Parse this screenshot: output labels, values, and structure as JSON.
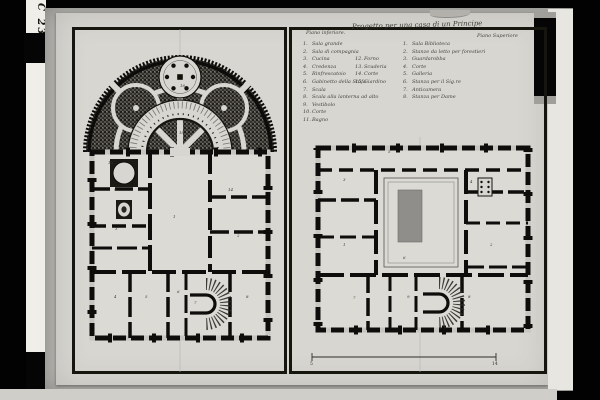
{
  "photo": {
    "shelf_mark": "C 23",
    "colors": {
      "background": "#020202",
      "paper": "#d7d6d1",
      "mount": "#b7b6b1",
      "ink": "#16160f",
      "courtyard_shading": "#8f8e8a"
    }
  },
  "legend": {
    "title": "Progetto per una casa di un Principe",
    "left_heading": "Piano inferiore.",
    "right_heading": "Piano Superiore",
    "left_items": [
      {
        "no": "1.",
        "text": "Sala grande"
      },
      {
        "no": "2.",
        "text": "Sala di compagnia"
      },
      {
        "no": "3.",
        "text": "Cucina",
        "no2": "12.",
        "text2": "Forno"
      },
      {
        "no": "4.",
        "text": "Credenza",
        "no2": "13.",
        "text2": "Scuderia"
      },
      {
        "no": "5.",
        "text": "Rinfrescatoio",
        "no2": "14.",
        "text2": "Corte"
      },
      {
        "no": "6.",
        "text": "Gabinetto della Stufa",
        "no2": "15.",
        "text2": "Giardino"
      },
      {
        "no": "7.",
        "text": "Scala"
      },
      {
        "no": "8.",
        "text": "Scala alla lanterna ad alto"
      },
      {
        "no": "9.",
        "text": "Vestibolo"
      },
      {
        "no": "10.",
        "text": "Corte"
      },
      {
        "no": "11.",
        "text": "Bagno"
      }
    ],
    "right_items": [
      {
        "no": "1.",
        "text": "Sala Biblioteca"
      },
      {
        "no": "2.",
        "text": "Stanze da letto per forestieri"
      },
      {
        "no": "3.",
        "text": "Guardarobba"
      },
      {
        "no": "4.",
        "text": "Corte"
      },
      {
        "no": "5.",
        "text": "Galleria"
      },
      {
        "no": "6.",
        "text": "Stanza per il Sig.re"
      },
      {
        "no": "7.",
        "text": "Anticamera"
      },
      {
        "no": "8.",
        "text": "Stanza per Dame"
      }
    ]
  },
  "scale_bar": {
    "start": "5",
    "end": "14"
  },
  "plans": {
    "left": {
      "room_numbers": [
        {
          "n": "16",
          "x": 108,
          "y": 60
        },
        {
          "n": "18",
          "x": 107,
          "y": 107
        },
        {
          "n": "10",
          "x": 36,
          "y": 137
        },
        {
          "n": "9",
          "x": 42,
          "y": 164
        },
        {
          "n": "14",
          "x": 156,
          "y": 164
        },
        {
          "n": "1",
          "x": 101,
          "y": 191
        },
        {
          "n": "3",
          "x": 43,
          "y": 203
        },
        {
          "n": "2",
          "x": 165,
          "y": 210
        },
        {
          "n": "4",
          "x": 42,
          "y": 271
        },
        {
          "n": "5",
          "x": 73,
          "y": 271
        },
        {
          "n": "6",
          "x": 105,
          "y": 266
        },
        {
          "n": "7",
          "x": 122,
          "y": 277
        },
        {
          "n": "8",
          "x": 174,
          "y": 271
        }
      ]
    },
    "right": {
      "room_numbers": [
        {
          "n": "5",
          "x": 96,
          "y": 126
        },
        {
          "n": "3",
          "x": 51,
          "y": 154
        },
        {
          "n": "4",
          "x": 178,
          "y": 156
        },
        {
          "n": "1",
          "x": 51,
          "y": 219
        },
        {
          "n": "2",
          "x": 198,
          "y": 219
        },
        {
          "n": "6",
          "x": 111,
          "y": 232
        },
        {
          "n": "7",
          "x": 61,
          "y": 272
        },
        {
          "n": "9",
          "x": 115,
          "y": 271
        },
        {
          "n": "8",
          "x": 176,
          "y": 271
        }
      ]
    }
  }
}
